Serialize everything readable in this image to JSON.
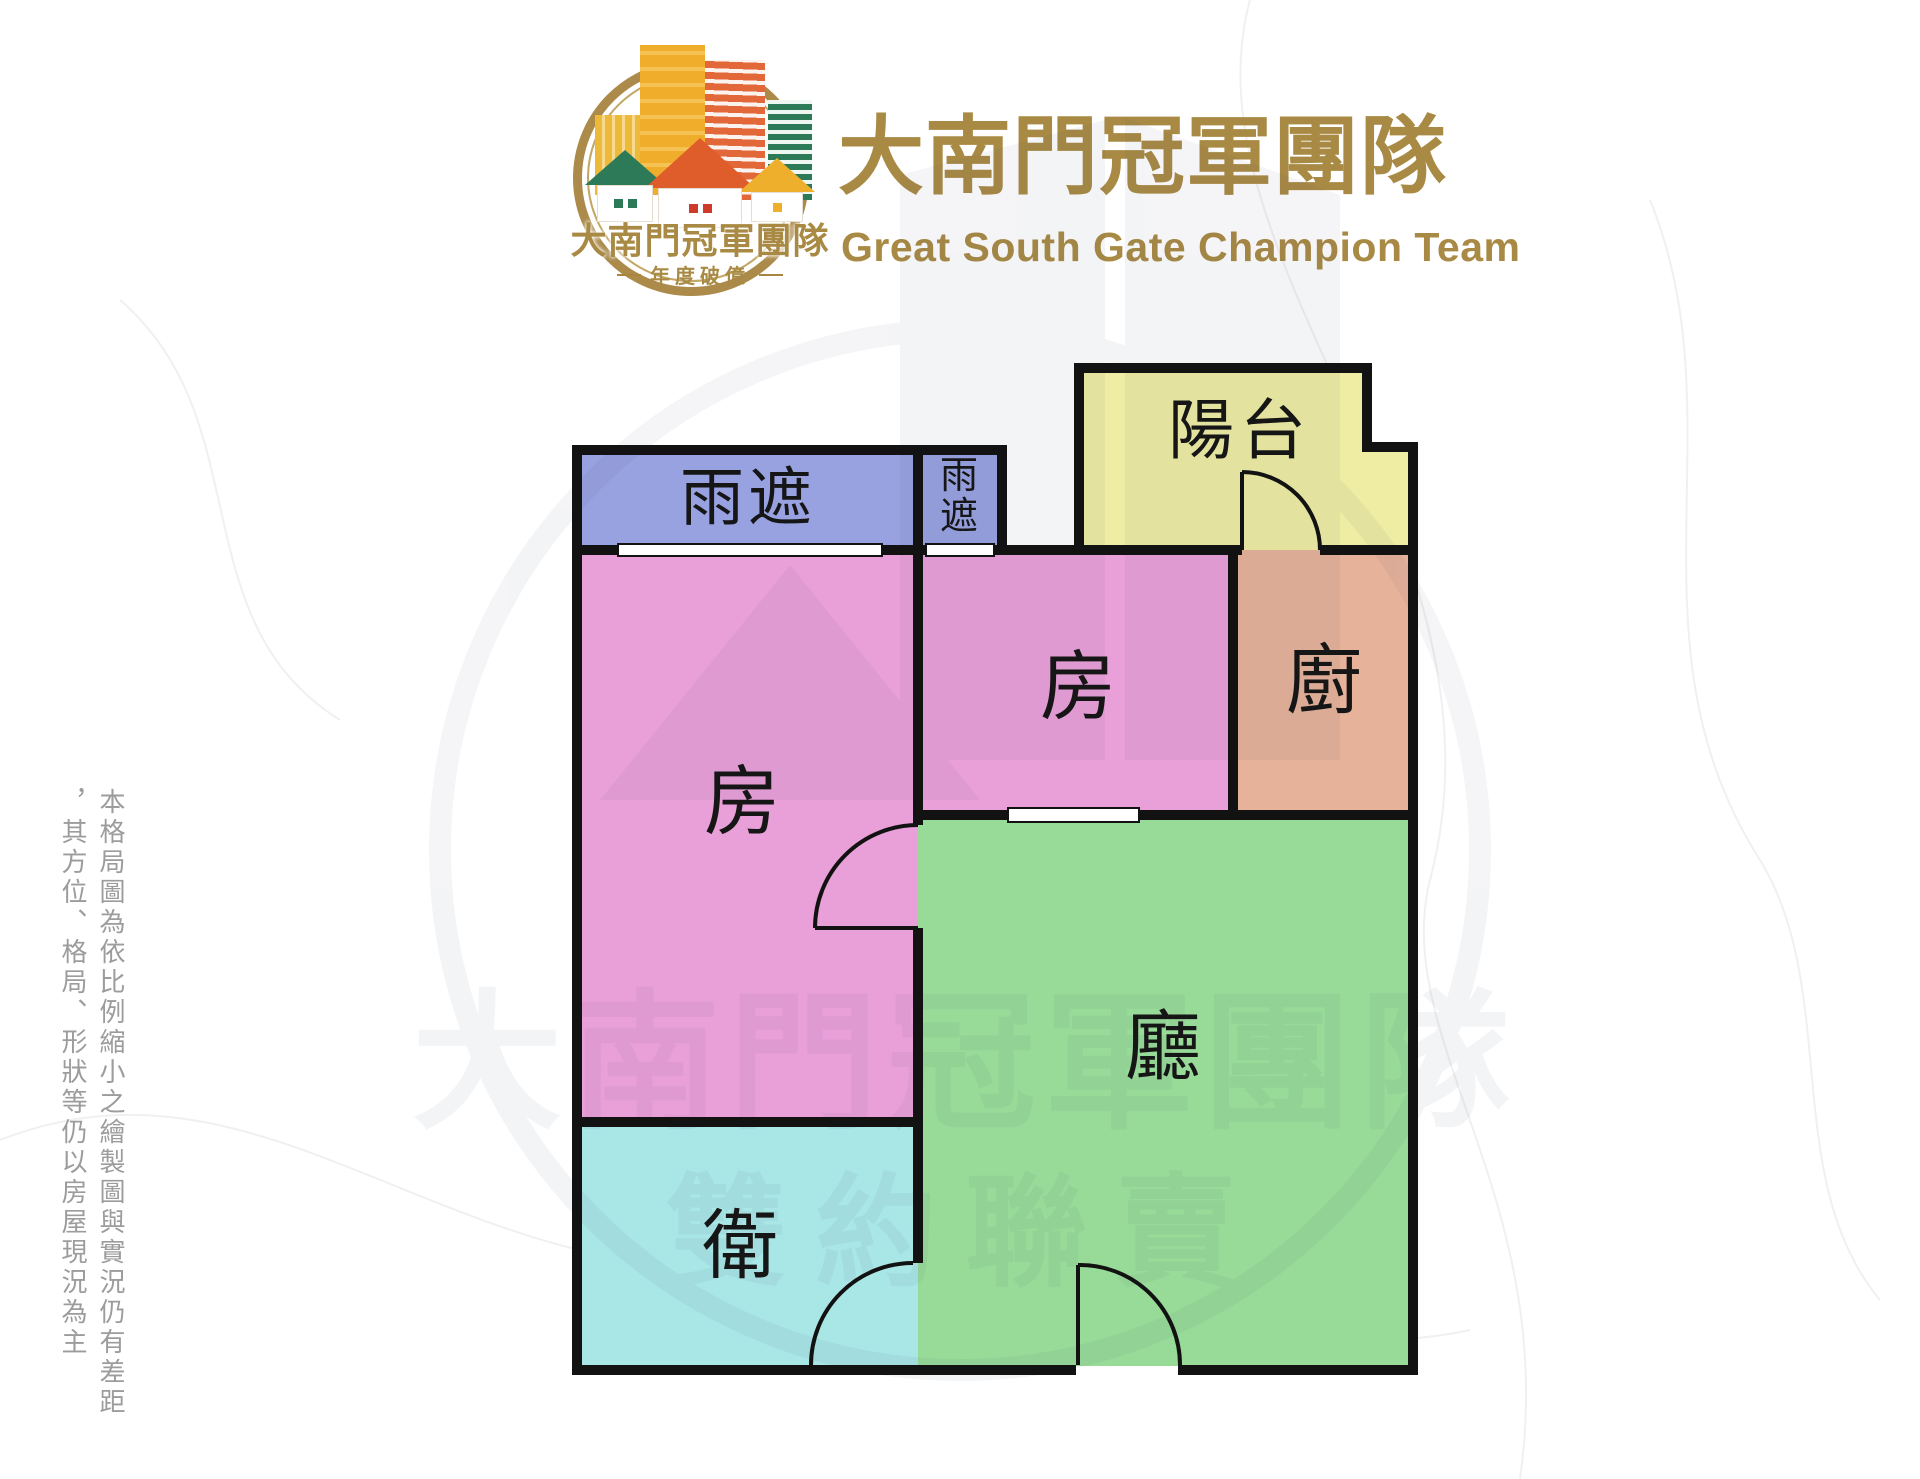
{
  "header": {
    "emblem": {
      "title": "大南門冠軍團隊",
      "tagline": "年度破億"
    },
    "title": "大南門冠軍團隊",
    "subtitle": "Great South Gate Champion Team",
    "brand_gold": "#a98a44"
  },
  "floorplan": {
    "rooms": {
      "canopy_large": {
        "label": "雨遮",
        "color": "#98a2e0"
      },
      "canopy_small": {
        "label": "雨遮",
        "color": "#98a2e0"
      },
      "balcony": {
        "label": "陽台",
        "color": "#efeca3"
      },
      "bedroom_left": {
        "label": "房",
        "color": "#e9a0d9"
      },
      "bedroom_middle": {
        "label": "房",
        "color": "#e9a0d9"
      },
      "kitchen": {
        "label": "廚",
        "color": "#e6b29a"
      },
      "living_room": {
        "label": "廳",
        "color": "#98db99"
      },
      "bathroom": {
        "label": "衛",
        "color": "#a9e6e6"
      }
    },
    "wall_color": "#121212"
  },
  "watermark": {
    "title": "大南門冠軍團隊",
    "subtitle": "雙約聯賣"
  },
  "disclaimer": {
    "column1": "本格局圖為依比例縮小之繪製圖與實況仍有差距",
    "column2": "，其方位、格局、形狀等仍以房屋現況為主"
  }
}
